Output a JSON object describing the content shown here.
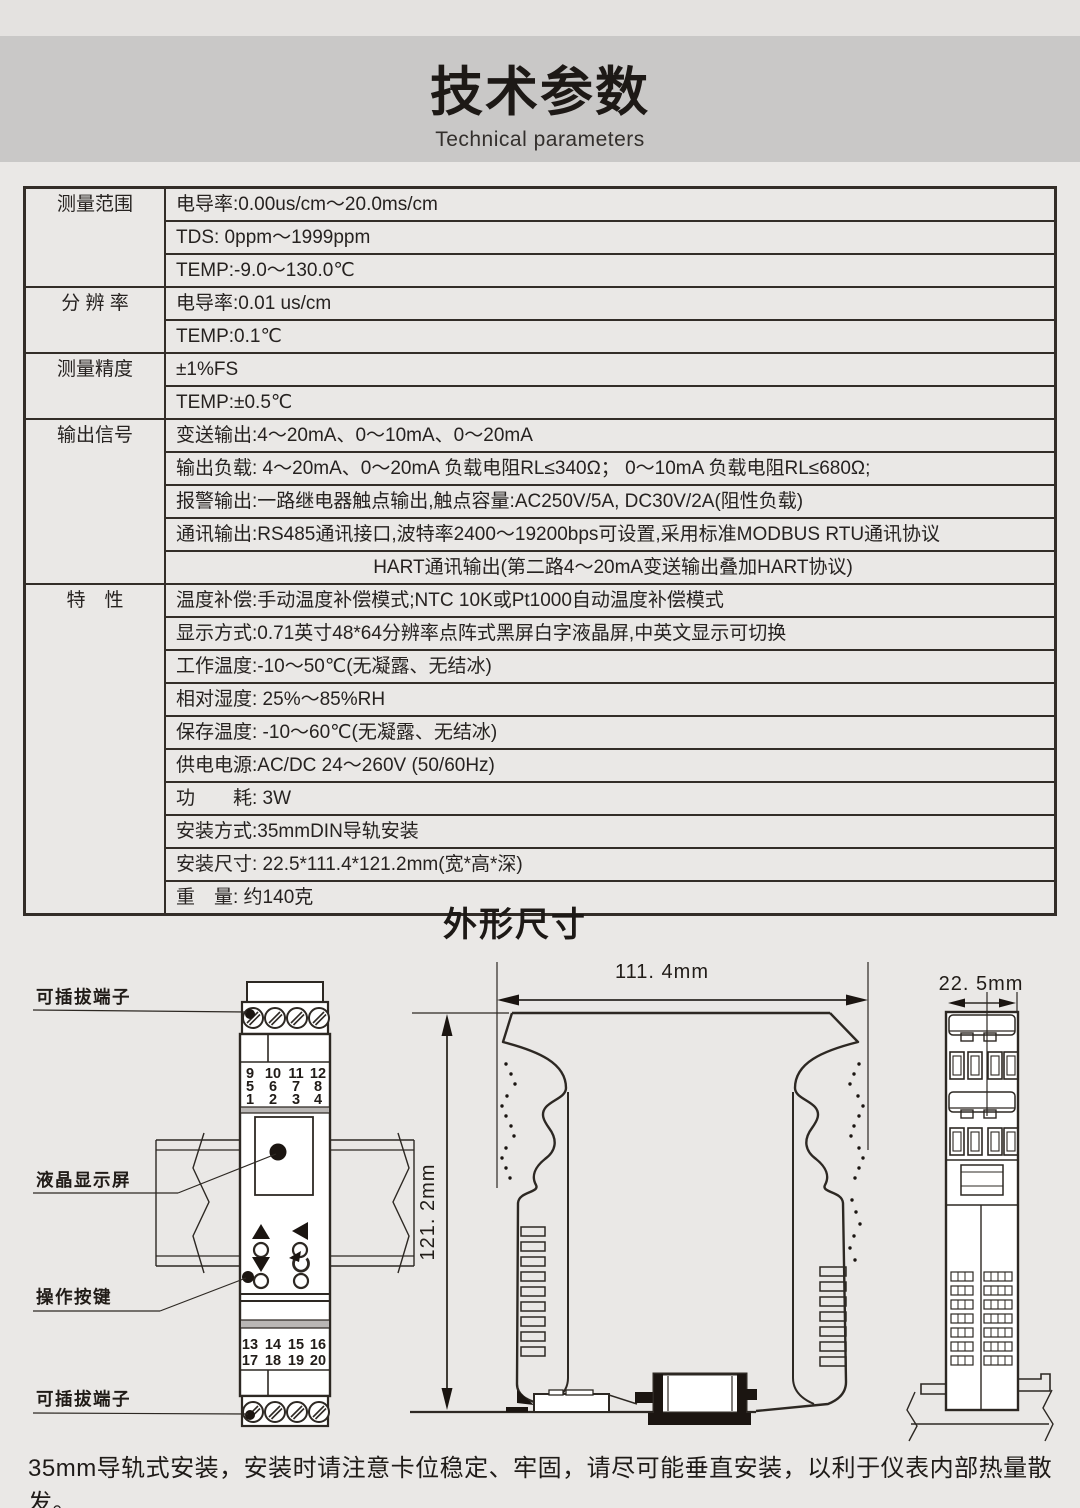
{
  "header": {
    "title": "技术参数",
    "subtitle": "Technical parameters"
  },
  "table": {
    "groups": [
      {
        "label": "测量范围",
        "rows": [
          "电导率:0.00us/cm～20.0ms/cm",
          "TDS: 0ppm～1999ppm",
          "TEMP:-9.0～130.0℃"
        ]
      },
      {
        "label": "分 辨 率",
        "rows": [
          "电导率:0.01 us/cm",
          "TEMP:0.1℃"
        ]
      },
      {
        "label": "测量精度",
        "rows": [
          "±1%FS",
          "TEMP:±0.5℃"
        ]
      },
      {
        "label": "输出信号",
        "rows": [
          "变送输出:4～20mA、0～10mA、0～20mA",
          "输出负载: 4～20mA、0～20mA 负载电阻RL≤340Ω； 0～10mA 负载电阻RL≤680Ω;",
          "报警输出:一路继电器触点输出,触点容量:AC250V/5A, DC30V/2A(阻性负载)",
          "通讯输出:RS485通讯接口,波特率2400～19200bps可设置,采用标准MODBUS RTU通讯协议",
          "HART通讯输出(第二路4～20mA变送输出叠加HART协议)"
        ]
      },
      {
        "label": "特　性",
        "rows": [
          "温度补偿:手动温度补偿模式;NTC 10K或Pt1000自动温度补偿模式",
          "显示方式:0.71英寸48*64分辨率点阵式黑屏白字液晶屏,中英文显示可切换",
          "工作温度:-10～50℃(无凝露、无结冰)",
          "相对湿度: 25%～85%RH",
          "保存温度: -10～60℃(无凝露、无结冰)",
          "供电电源:AC/DC 24～260V (50/60Hz)",
          "功　　耗: 3W",
          "安装方式:35mmDIN导轨安装",
          "安装尺寸: 22.5*111.4*121.2mm(宽*高*深)",
          "重　量: 约140克"
        ]
      }
    ]
  },
  "dimensions_section": {
    "title": "外形尺寸",
    "width_label": "111. 4mm",
    "height_label": "121. 2mm",
    "depth_label": "22. 5mm"
  },
  "diagram": {
    "labels": {
      "top_terminal": "可插拔端子",
      "lcd": "液晶显示屏",
      "buttons": "操作按键",
      "bottom_terminal": "可插拔端子"
    },
    "terminals": {
      "r1": [
        "9",
        "10",
        "11",
        "12"
      ],
      "r2": [
        "5",
        "6",
        "7",
        "8"
      ],
      "r3": [
        "1",
        "2",
        "3",
        "4"
      ],
      "r4": [
        "13",
        "14",
        "15",
        "16"
      ],
      "r5": [
        "17",
        "18",
        "19",
        "20"
      ]
    },
    "colors": {
      "terminal_red": "#d93a20"
    }
  },
  "footer": {
    "note": "35mm导轨式安装，安装时请注意卡位稳定、牢固，请尽可能垂直安装，以利于仪表内部热量散发。"
  }
}
